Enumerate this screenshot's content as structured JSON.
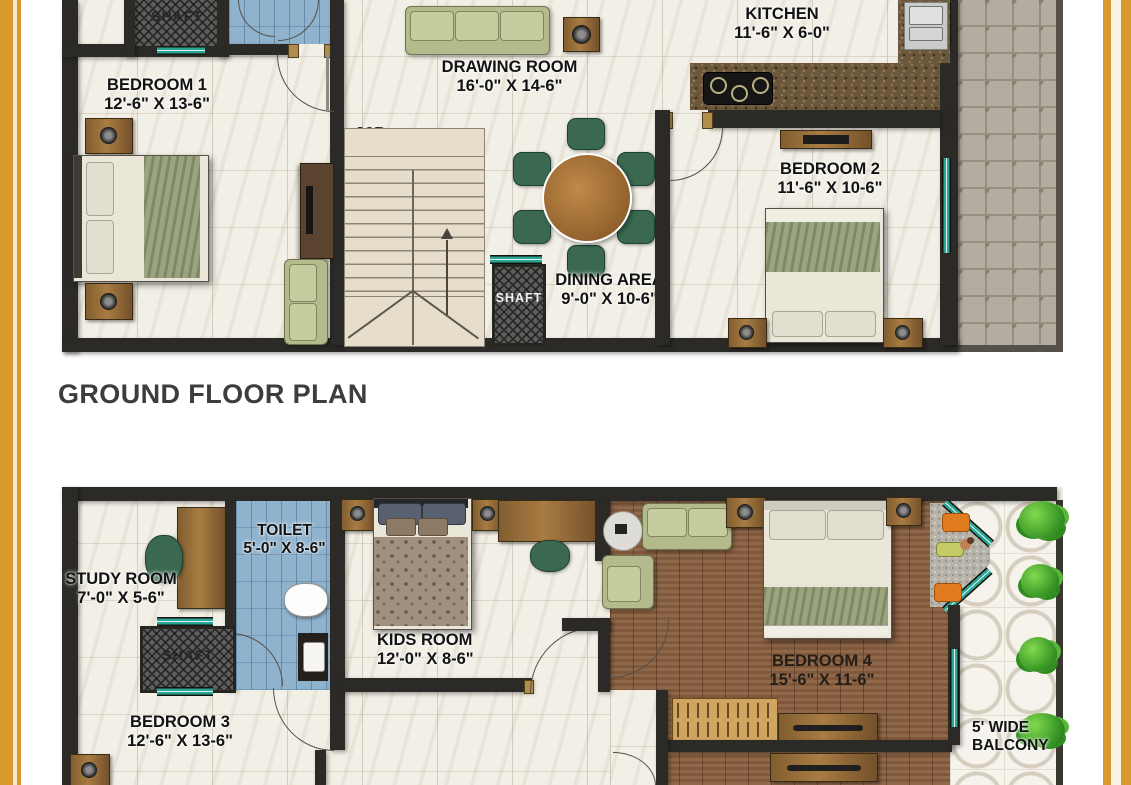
{
  "title": "GROUND FLOOR PLAN",
  "ground_floor": {
    "bedroom1": {
      "label": "BEDROOM 1",
      "size": "12'-6\" X 13-6\""
    },
    "shaft_top": {
      "label": "SHAFT"
    },
    "drawing_room": {
      "label": "DRAWING ROOM",
      "size": "16'-0\" X 14-6\""
    },
    "kitchen": {
      "label": "KITCHEN",
      "size": "11'-6\" X 6-0\""
    },
    "bedroom2": {
      "label": "BEDROOM 2",
      "size": "11'-6\" X 10-6\""
    },
    "dining": {
      "label": "DINING AREA",
      "size": "9'-0\" X 10-6\""
    },
    "shaft_stairs": {
      "label": "SHAFT"
    },
    "stairs": {
      "label": "UP"
    }
  },
  "upper_floor": {
    "study": {
      "label": "STUDY ROOM",
      "size": "7'-0\" X 5-6\""
    },
    "toilet": {
      "label": "TOILET",
      "size": "5'-0\" X 8-6\""
    },
    "shaft": {
      "label": "SHAFT"
    },
    "kids": {
      "label": "KIDS ROOM",
      "size": "12'-0\" X 8-6\""
    },
    "bedroom3": {
      "label": "BEDROOM 3",
      "size": "12'-6\" X 13-6\""
    },
    "bedroom4": {
      "label": "BEDROOM 4",
      "size": "15'-6\" X 11-6\""
    },
    "balcony": {
      "line1": "5' WIDE",
      "line2": "BALCONY"
    }
  },
  "colors": {
    "border_gold": "#D8992D",
    "border_cream": "#F3E9CB",
    "wall": "#2B2A26",
    "window_teal": "#2AA593",
    "marble_floor": "#F2EFE6",
    "wood_floor": "#8A6040",
    "bath_tile_blue": "#8FB2CD",
    "paving_gray": "#B3ACA0",
    "balcony_tile": "#F5F3EC",
    "sofa_green": "#B3BA8C",
    "dining_chair_green": "#3A694F",
    "counter_granite": "#6B573C",
    "title_text": "#3D3D3D",
    "label_text": "#121212"
  }
}
